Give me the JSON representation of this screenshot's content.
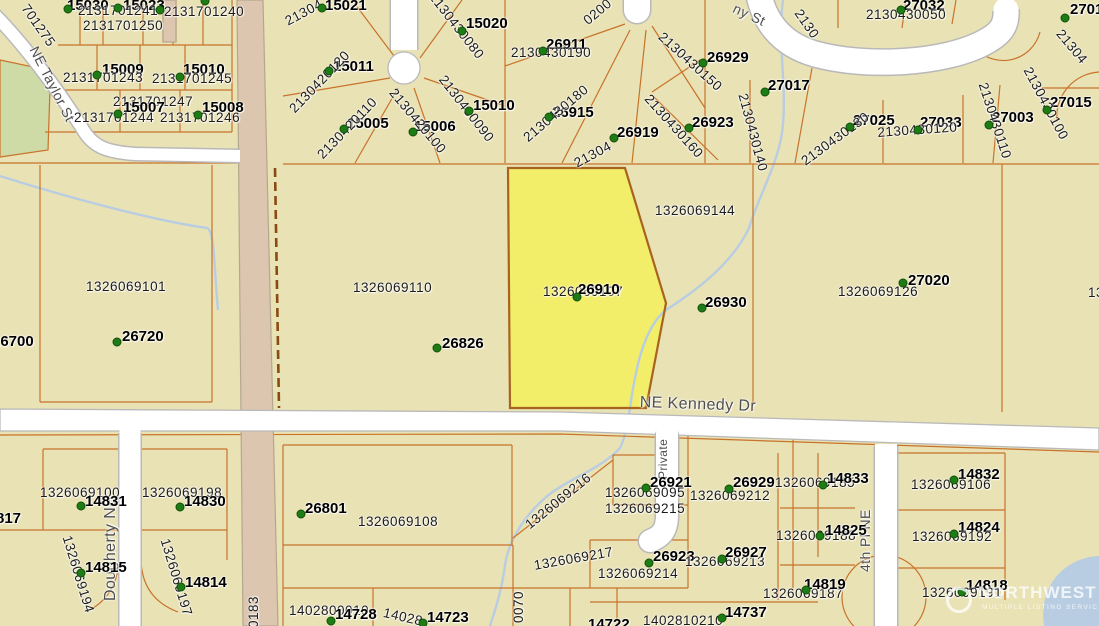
{
  "map": {
    "watermark": {
      "brand": "NORTHWEST",
      "tagline": "MULTIPLE LISTING SERVICE"
    },
    "colors": {
      "background": "#e9e2b5",
      "road_fill": "#ffffff",
      "road_casing": "#b9b9b9",
      "major_road_fill": "#dcc6af",
      "major_road_casing": "#b5a78e",
      "parcel_line": "#c8732a",
      "parcel_line_dark": "#8a4a12",
      "highlight_fill": "#f3ee6a",
      "highlight_stroke": "#a8641e",
      "dot": "#1e7c17",
      "dot_stroke": "#115008",
      "water": "#b9cde2",
      "green_area": "#cfdba6",
      "label": "#1b1b1b",
      "street_label": "#4f4f4f",
      "watermark": "#ffffff"
    },
    "labels": [
      {
        "t": "NE Taylor St",
        "x": 40,
        "y": 44,
        "k": "street",
        "r": 63,
        "s": 14
      },
      {
        "t": "ny St",
        "x": 737,
        "y": 1,
        "k": "street",
        "r": 25,
        "s": 14
      },
      {
        "t": "NE Kennedy Dr",
        "x": 640,
        "y": 395,
        "k": "street",
        "r": 2,
        "s": 16
      },
      {
        "t": "Dougherty NE",
        "x": 103,
        "y": 601,
        "k": "street",
        "r": -90,
        "s": 16
      },
      {
        "t": "4th Pl NE",
        "x": 858,
        "y": 572,
        "k": "street",
        "r": -90,
        "s": 14
      },
      {
        "t": "Private",
        "x": 657,
        "y": 479,
        "k": "street",
        "r": -90,
        "s": 12
      },
      {
        "t": "15030",
        "x": 67,
        "y": -2,
        "k": "bold"
      },
      {
        "t": "15023",
        "x": 123,
        "y": -2,
        "k": "bold"
      },
      {
        "t": "2131701241",
        "x": 78,
        "y": 4,
        "k": "num"
      },
      {
        "t": "2131701240",
        "x": 164,
        "y": 5,
        "k": "num"
      },
      {
        "t": "2131701250",
        "x": 83,
        "y": 19,
        "k": "num"
      },
      {
        "t": "701275",
        "x": 30,
        "y": 2,
        "k": "num",
        "r": 55
      },
      {
        "t": "15009",
        "x": 102,
        "y": 62,
        "k": "bold"
      },
      {
        "t": "2131701243",
        "x": 63,
        "y": 71,
        "k": "num"
      },
      {
        "t": "15010",
        "x": 183,
        "y": 62,
        "k": "bold"
      },
      {
        "t": "2131701245",
        "x": 152,
        "y": 72,
        "k": "num"
      },
      {
        "t": "2131701247",
        "x": 113,
        "y": 95,
        "k": "num"
      },
      {
        "t": "15007",
        "x": 123,
        "y": 100,
        "k": "bold"
      },
      {
        "t": "2131701244",
        "x": 74,
        "y": 111,
        "k": "num"
      },
      {
        "t": "15008",
        "x": 202,
        "y": 100,
        "k": "bold"
      },
      {
        "t": "2131701246",
        "x": 160,
        "y": 111,
        "k": "num"
      },
      {
        "t": "15021",
        "x": 325,
        "y": -2,
        "k": "bold"
      },
      {
        "t": "21304",
        "x": 283,
        "y": 16,
        "k": "num",
        "r": -28
      },
      {
        "t": "15011",
        "x": 333,
        "y": 59,
        "k": "bold"
      },
      {
        "t": "2130420120",
        "x": 287,
        "y": 106,
        "k": "num",
        "r": -46
      },
      {
        "t": "15005",
        "x": 347,
        "y": 116,
        "k": "bold"
      },
      {
        "t": "2130420110",
        "x": 315,
        "y": 152,
        "k": "num",
        "r": -46
      },
      {
        "t": "15006",
        "x": 414,
        "y": 119,
        "k": "bold"
      },
      {
        "t": "2130420100",
        "x": 397,
        "y": 86,
        "k": "num",
        "r": 50
      },
      {
        "t": "15020",
        "x": 466,
        "y": 16,
        "k": "bold"
      },
      {
        "t": "2130430080",
        "x": 437,
        "y": -10,
        "k": "num",
        "r": 52
      },
      {
        "t": "15010",
        "x": 473,
        "y": 98,
        "k": "bold"
      },
      {
        "t": "2130430090",
        "x": 447,
        "y": 73,
        "k": "num",
        "r": 52
      },
      {
        "t": "26911",
        "x": 546,
        "y": 37,
        "k": "bold"
      },
      {
        "t": "2130430190",
        "x": 511,
        "y": 46,
        "k": "num"
      },
      {
        "t": "0200",
        "x": 581,
        "y": 17,
        "k": "num",
        "r": -40
      },
      {
        "t": "26915",
        "x": 552,
        "y": 105,
        "k": "bold"
      },
      {
        "t": "2130430180",
        "x": 521,
        "y": 134,
        "k": "num",
        "r": -40
      },
      {
        "t": "26919",
        "x": 617,
        "y": 125,
        "k": "bold"
      },
      {
        "t": "21304",
        "x": 572,
        "y": 158,
        "k": "num",
        "r": -28
      },
      {
        "t": "2130",
        "x": 803,
        "y": 7,
        "k": "num",
        "r": 55
      },
      {
        "t": "27032",
        "x": 903,
        "y": -2,
        "k": "bold"
      },
      {
        "t": "2130430050",
        "x": 866,
        "y": 8,
        "k": "num"
      },
      {
        "t": "27016",
        "x": 1070,
        "y": 2,
        "k": "bold"
      },
      {
        "t": "21304",
        "x": 1064,
        "y": 27,
        "k": "num",
        "r": 50
      },
      {
        "t": "26929",
        "x": 707,
        "y": 50,
        "k": "bold"
      },
      {
        "t": "2130430150",
        "x": 665,
        "y": 30,
        "k": "num",
        "r": 42
      },
      {
        "t": "27017",
        "x": 768,
        "y": 78,
        "k": "bold"
      },
      {
        "t": "2130430140",
        "x": 749,
        "y": 92,
        "k": "num",
        "r": 75
      },
      {
        "t": "26923",
        "x": 692,
        "y": 115,
        "k": "bold"
      },
      {
        "t": "2130430160",
        "x": 652,
        "y": 92,
        "k": "num",
        "r": 48
      },
      {
        "t": "27025",
        "x": 853,
        "y": 113,
        "k": "bold"
      },
      {
        "t": "2130430130",
        "x": 799,
        "y": 157,
        "k": "num",
        "r": -36
      },
      {
        "t": "27033",
        "x": 920,
        "y": 115,
        "k": "bold"
      },
      {
        "t": "2130430120",
        "x": 877,
        "y": 126,
        "k": "num",
        "r": -4
      },
      {
        "t": "27003",
        "x": 992,
        "y": 110,
        "k": "bold"
      },
      {
        "t": "2130430110",
        "x": 989,
        "y": 81,
        "k": "num",
        "r": 72
      },
      {
        "t": "27015",
        "x": 1050,
        "y": 95,
        "k": "bold"
      },
      {
        "t": "2130430100",
        "x": 1033,
        "y": 65,
        "k": "num",
        "r": 62
      },
      {
        "t": "1326069144",
        "x": 655,
        "y": 204,
        "k": "num"
      },
      {
        "t": "1326069107",
        "x": 543,
        "y": 285,
        "k": "num"
      },
      {
        "t": "26910",
        "x": 578,
        "y": 282,
        "k": "bold"
      },
      {
        "t": "26930",
        "x": 705,
        "y": 295,
        "k": "bold"
      },
      {
        "t": "1326069110",
        "x": 353,
        "y": 281,
        "k": "num"
      },
      {
        "t": "26826",
        "x": 442,
        "y": 336,
        "k": "bold"
      },
      {
        "t": "1326069101",
        "x": 86,
        "y": 280,
        "k": "num"
      },
      {
        "t": "26720",
        "x": 122,
        "y": 329,
        "k": "bold"
      },
      {
        "t": "26700",
        "x": -8,
        "y": 334,
        "k": "bold"
      },
      {
        "t": "27020",
        "x": 908,
        "y": 273,
        "k": "bold"
      },
      {
        "t": "1326069126",
        "x": 838,
        "y": 285,
        "k": "num"
      },
      {
        "t": "1326069",
        "x": 1088,
        "y": 286,
        "k": "num"
      },
      {
        "t": "1326069100",
        "x": 40,
        "y": 486,
        "k": "num"
      },
      {
        "t": "14831",
        "x": 85,
        "y": 494,
        "k": "bold"
      },
      {
        "t": "1326069198",
        "x": 142,
        "y": 486,
        "k": "num"
      },
      {
        "t": "14830",
        "x": 184,
        "y": 494,
        "k": "bold"
      },
      {
        "t": "817",
        "x": -4,
        "y": 511,
        "k": "bold"
      },
      {
        "t": "1326069194",
        "x": 73,
        "y": 534,
        "k": "num",
        "r": 73
      },
      {
        "t": "14815",
        "x": 85,
        "y": 560,
        "k": "bold"
      },
      {
        "t": "1326069197",
        "x": 171,
        "y": 537,
        "k": "num",
        "r": 73
      },
      {
        "t": "14814",
        "x": 185,
        "y": 575,
        "k": "bold"
      },
      {
        "t": "0183",
        "x": 247,
        "y": 628,
        "k": "num",
        "r": -90
      },
      {
        "t": "26801",
        "x": 305,
        "y": 501,
        "k": "bold"
      },
      {
        "t": "1326069108",
        "x": 358,
        "y": 515,
        "k": "num"
      },
      {
        "t": "1402800010",
        "x": 289,
        "y": 604,
        "k": "num"
      },
      {
        "t": "14728",
        "x": 335,
        "y": 607,
        "k": "bold"
      },
      {
        "t": "14028",
        "x": 385,
        "y": 606,
        "k": "num",
        "r": 13
      },
      {
        "t": "14723",
        "x": 427,
        "y": 610,
        "k": "bold"
      },
      {
        "t": "0070",
        "x": 512,
        "y": 623,
        "k": "num",
        "r": -90
      },
      {
        "t": "1326069216",
        "x": 523,
        "y": 521,
        "k": "num",
        "r": -39
      },
      {
        "t": "26921",
        "x": 650,
        "y": 475,
        "k": "bold"
      },
      {
        "t": "1326069095",
        "x": 605,
        "y": 486,
        "k": "num"
      },
      {
        "t": "1326069212",
        "x": 690,
        "y": 489,
        "k": "num"
      },
      {
        "t": "26929",
        "x": 733,
        "y": 475,
        "k": "bold"
      },
      {
        "t": "1326069215",
        "x": 605,
        "y": 502,
        "k": "num"
      },
      {
        "t": "1326069217",
        "x": 533,
        "y": 559,
        "k": "num",
        "r": -10
      },
      {
        "t": "26923",
        "x": 653,
        "y": 549,
        "k": "bold"
      },
      {
        "t": "1326069213",
        "x": 685,
        "y": 555,
        "k": "num"
      },
      {
        "t": "26927",
        "x": 725,
        "y": 545,
        "k": "bold"
      },
      {
        "t": "1326069214",
        "x": 598,
        "y": 567,
        "k": "num"
      },
      {
        "t": "1402810210",
        "x": 643,
        "y": 614,
        "k": "num"
      },
      {
        "t": "14737",
        "x": 725,
        "y": 605,
        "k": "bold"
      },
      {
        "t": "14722",
        "x": 588,
        "y": 617,
        "k": "bold"
      },
      {
        "t": "1326069185",
        "x": 775,
        "y": 476,
        "k": "num"
      },
      {
        "t": "14833",
        "x": 827,
        "y": 471,
        "k": "bold"
      },
      {
        "t": "1326069188",
        "x": 776,
        "y": 529,
        "k": "num"
      },
      {
        "t": "14825",
        "x": 825,
        "y": 523,
        "k": "bold"
      },
      {
        "t": "1326069187",
        "x": 763,
        "y": 587,
        "k": "num"
      },
      {
        "t": "14819",
        "x": 804,
        "y": 577,
        "k": "bold"
      },
      {
        "t": "14832",
        "x": 958,
        "y": 467,
        "k": "bold"
      },
      {
        "t": "1326069106",
        "x": 911,
        "y": 478,
        "k": "num"
      },
      {
        "t": "14824",
        "x": 958,
        "y": 520,
        "k": "bold"
      },
      {
        "t": "1326069192",
        "x": 912,
        "y": 530,
        "k": "num"
      },
      {
        "t": "14818",
        "x": 966,
        "y": 578,
        "k": "bold"
      },
      {
        "t": "1326069191",
        "x": 922,
        "y": 586,
        "k": "num"
      }
    ],
    "dots": [
      [
        68,
        9
      ],
      [
        118,
        8
      ],
      [
        160,
        10
      ],
      [
        205,
        1
      ],
      [
        97,
        75
      ],
      [
        180,
        77
      ],
      [
        118,
        114
      ],
      [
        198,
        115
      ],
      [
        322,
        8
      ],
      [
        329,
        71
      ],
      [
        344,
        129
      ],
      [
        413,
        132
      ],
      [
        462,
        31
      ],
      [
        469,
        111
      ],
      [
        543,
        51
      ],
      [
        549,
        117
      ],
      [
        614,
        138
      ],
      [
        901,
        10
      ],
      [
        703,
        63
      ],
      [
        765,
        92
      ],
      [
        689,
        128
      ],
      [
        850,
        127
      ],
      [
        918,
        130
      ],
      [
        989,
        125
      ],
      [
        1047,
        110
      ],
      [
        1065,
        18
      ],
      [
        577,
        297
      ],
      [
        702,
        308
      ],
      [
        437,
        348
      ],
      [
        117,
        342
      ],
      [
        903,
        283
      ],
      [
        81,
        506
      ],
      [
        180,
        507
      ],
      [
        81,
        573
      ],
      [
        181,
        587
      ],
      [
        301,
        514
      ],
      [
        331,
        621
      ],
      [
        423,
        623
      ],
      [
        646,
        488
      ],
      [
        729,
        489
      ],
      [
        649,
        563
      ],
      [
        722,
        559
      ],
      [
        722,
        618
      ],
      [
        823,
        485
      ],
      [
        820,
        536
      ],
      [
        806,
        590
      ],
      [
        954,
        480
      ],
      [
        954,
        534
      ],
      [
        962,
        592
      ]
    ]
  }
}
